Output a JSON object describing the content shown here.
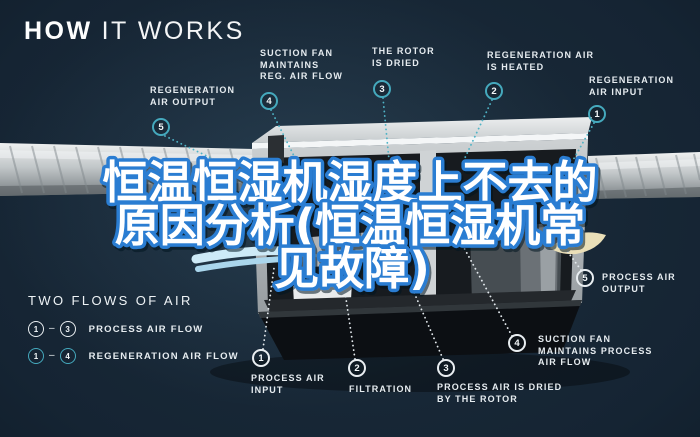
{
  "title": {
    "bold": "HOW",
    "light": "IT WORKS"
  },
  "overlay": {
    "line1": "恒温恒湿机湿度上不去的",
    "line2": "原因分析(恒温恒湿机常",
    "line3": "见故障)"
  },
  "legend": {
    "heading": "TWO FLOWS OF AIR",
    "rows": [
      {
        "from": "1",
        "to": "3",
        "label": "PROCESS AIR FLOW",
        "circle_style": "white"
      },
      {
        "from": "1",
        "to": "4",
        "label": "REGENERATION AIR FLOW",
        "circle_style": "teal"
      }
    ]
  },
  "callouts": {
    "reg_air_output": {
      "num": "5",
      "lines": [
        "REGENERATION",
        "AIR OUTPUT"
      ]
    },
    "suction_fan_reg": {
      "num": "4",
      "lines": [
        "SUCTION FAN",
        "MAINTAINS",
        "REG. AIR FLOW"
      ]
    },
    "rotor_dried": {
      "num": "3",
      "lines": [
        "THE ROTOR",
        "IS DRIED"
      ]
    },
    "reg_air_heated": {
      "num": "2",
      "lines": [
        "REGENERATION AIR",
        "IS HEATED"
      ]
    },
    "reg_air_input": {
      "num": "1",
      "lines": [
        "REGENERATION",
        "AIR INPUT"
      ]
    },
    "process_air_output": {
      "num": "5",
      "lines": [
        "PROCESS AIR",
        "OUTPUT"
      ]
    },
    "process_air_input": {
      "num": "1",
      "lines": [
        "PROCESS AIR",
        "INPUT"
      ]
    },
    "filtration": {
      "num": "2",
      "lines": [
        "FILTRATION"
      ]
    },
    "process_air_dried": {
      "num": "3",
      "lines": [
        "PROCESS AIR IS DRIED",
        "BY THE ROTOR"
      ]
    },
    "suction_fan_process": {
      "num": "4",
      "lines": [
        "SUCTION FAN",
        "MAINTAINS PROCESS",
        "AIR FLOW"
      ]
    }
  },
  "colors": {
    "accent_teal": "#45a9bd",
    "badge_white": "#e9eef1",
    "overlay_text_fill": "#ffffff",
    "overlay_text_stroke": "#2a7dd2",
    "background_navy": "#152433"
  }
}
